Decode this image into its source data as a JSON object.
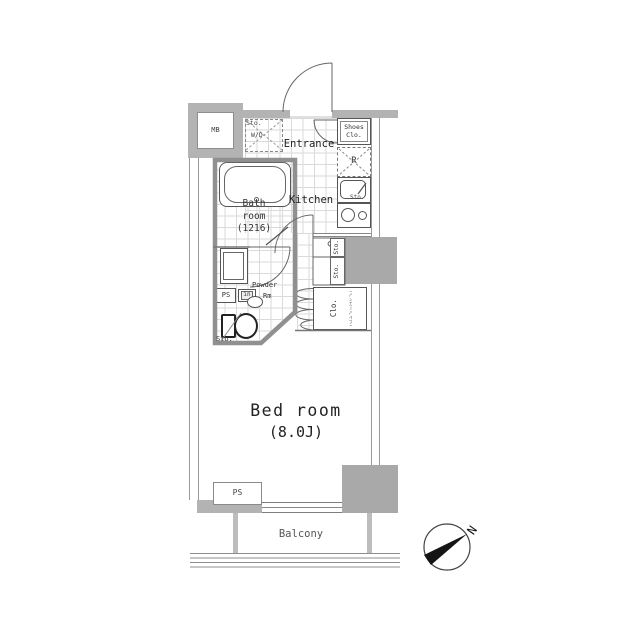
{
  "plan": {
    "meter_box": "MB",
    "laundry": {
      "line1": "Sto.",
      "line2": "W/D"
    },
    "entrance": "Entrance",
    "kitchen": {
      "name": "Kitchen",
      "shoes_closet_1": "Shoes",
      "shoes_closet_2": "Clo.",
      "refrigerator": "R",
      "storage": "Sto."
    },
    "bathroom": {
      "line1": "Bath",
      "line2": "room",
      "line3": "(1216)"
    },
    "powder_room": {
      "line1": "Powder",
      "line2": "Rm",
      "pipe_space": "PS",
      "inlet": "in",
      "toilet_storage": "Sto."
    },
    "storage_column": {
      "storage1": "Sto.",
      "storage2": "Sto.",
      "closet": "Clo.",
      "closet_note": "(ハンガーパイプ)"
    },
    "bedroom": {
      "name": "Bed room",
      "size": "(8.0J)",
      "pipe_space": "PS"
    },
    "balcony": "Balcony",
    "compass_north": "N"
  },
  "colors": {
    "wall": "#b3b3b3",
    "pillar": "#a9a9a9",
    "line": "#666666",
    "tile": "#dadada",
    "text": "#333333"
  }
}
